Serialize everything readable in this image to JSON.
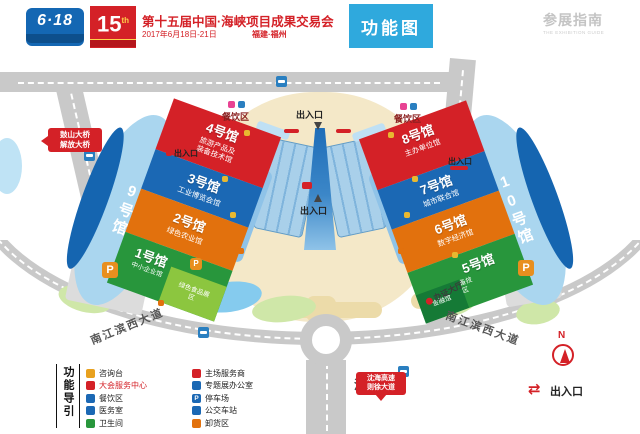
{
  "header": {
    "logo_618": "6·18",
    "logo_15": "15",
    "logo_15_sup": "th",
    "title": "第十五届中国·海峡项目成果交易会",
    "date": "2017年6月18日-21日",
    "city": "福建·福州",
    "tab": "功能图",
    "guide": "参展指南",
    "guide_en": "THE EXHIBITION GUIDE"
  },
  "map": {
    "oval_left": "9号馆",
    "oval_right": "10号馆",
    "halls_left": [
      {
        "no": "4号馆",
        "sub": "旅游产品及装备技术馆"
      },
      {
        "no": "3号馆",
        "sub": "工业博览会馆"
      },
      {
        "no": "2号馆",
        "sub": "绿色农业馆"
      },
      {
        "no": "1号馆",
        "sub": "中小企业馆"
      }
    ],
    "hall1_annex": "绿色食品展区",
    "halls_right": [
      {
        "no": "8号馆",
        "sub": "主办单位馆"
      },
      {
        "no": "7号馆",
        "sub": "城市联合馆"
      },
      {
        "no": "6号馆",
        "sub": "数字经济馆"
      },
      {
        "no": "5号馆",
        "sub": "海洋装备技术展区"
      }
    ],
    "hall5_annex": "金融馆",
    "office": "办公楼",
    "dining": "餐饮区",
    "entrance": "出入口",
    "badge_hall": "办证大厅",
    "left_badge_line1": "鼓山大桥",
    "left_badge_line2": "解放大桥",
    "right_badge_line1": "沈海高速",
    "right_badge_line2": "则徐大道",
    "road_left": "南江滨西大道",
    "road_right": "南江滨西大道",
    "road_bottom": "潘墩路"
  },
  "icons": {
    "parking": "P",
    "compass_n": "N",
    "exit_arrows": "⇄"
  },
  "legend": {
    "title": "功能导引",
    "items1": [
      {
        "label": "咨询台",
        "color": "#e8a11f"
      },
      {
        "label": "大会服务中心",
        "color": "#d42127"
      },
      {
        "label": "餐饮区",
        "color": "#1b68b4"
      },
      {
        "label": "医务室",
        "color": "#1b68b4"
      },
      {
        "label": "卫生间",
        "color": "#28963c"
      }
    ],
    "items2": [
      {
        "label": "主场服务商",
        "color": "#d42127"
      },
      {
        "label": "专题展办公室",
        "color": "#1b68b4"
      },
      {
        "label": "停车场",
        "color": "#1b68b4"
      },
      {
        "label": "公交车站",
        "color": "#1b68b4"
      },
      {
        "label": "卸货区",
        "color": "#e2710d"
      }
    ],
    "exit_label": "出入口"
  },
  "colors": {
    "accent_blue": "#2fa9dd",
    "hall_red": "#d42127",
    "hall_blue": "#1b68b4",
    "hall_orange": "#e2710d",
    "hall_green": "#28963c",
    "oval_blue": "#aad6ef",
    "road_gray": "#c9c9c9",
    "plaza_beige": "#f4e8c8"
  }
}
